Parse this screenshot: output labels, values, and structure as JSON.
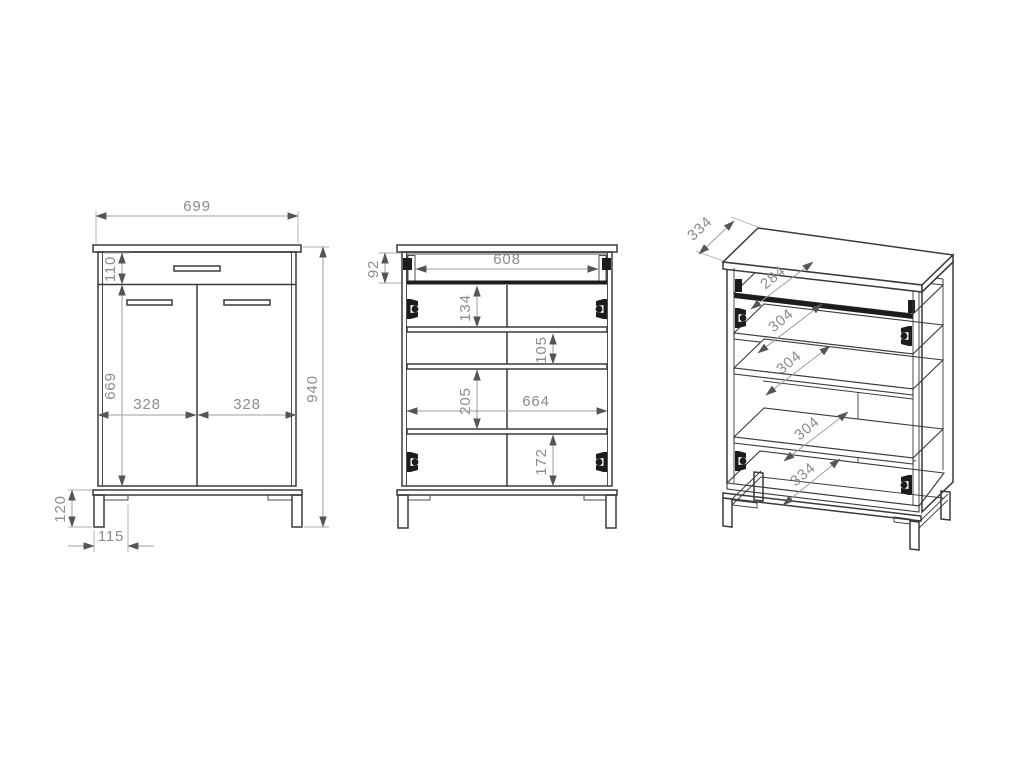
{
  "colors": {
    "background": "#ffffff",
    "object_line": "#3a3a3a",
    "dimension_line": "#9e9e9e",
    "dimension_text": "#8c8c8c",
    "hardware": "#1c1c1c"
  },
  "views": {
    "front": {
      "overall_width": "699",
      "drawer_front_height": "110",
      "door_height": "669",
      "left_door_width": "328",
      "right_door_width": "328",
      "overall_height": "940",
      "leg_height": "120",
      "leg_foot_width": "115"
    },
    "open_front": {
      "drawer_box_height": "92",
      "drawer_box_width": "608",
      "compartment_1_height": "134",
      "compartment_2_height": "105",
      "compartment_3_height": "205",
      "interior_width": "664",
      "compartment_4_height": "172"
    },
    "perspective": {
      "overall_depth": "334",
      "drawer_shelf_depth": "284",
      "shelf_2_depth": "304",
      "shelf_3_depth": "304",
      "shelf_4_depth": "304",
      "bottom_shelf_depth": "334"
    }
  }
}
